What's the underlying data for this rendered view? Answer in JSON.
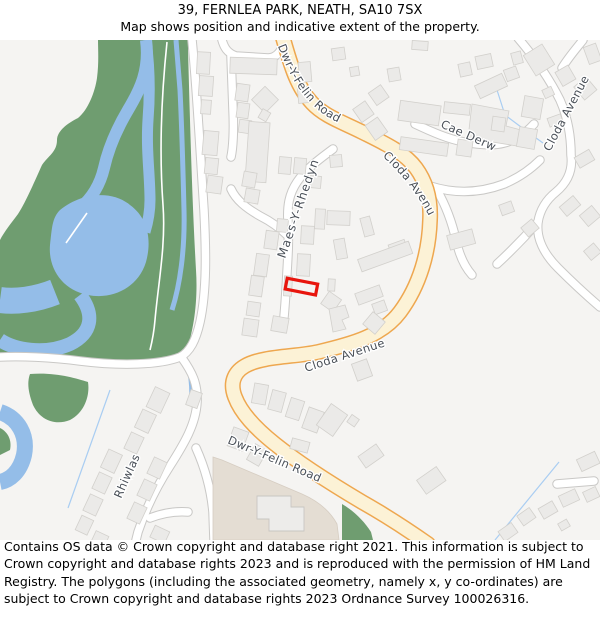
{
  "header": {
    "title": "39, FERNLEA PARK, NEATH, SA10 7SX",
    "subtitle": "Map shows position and indicative extent of the property."
  },
  "map": {
    "street_labels": {
      "dwr_y_felin_road_top": "Dwr-Y-Felin Road",
      "dwr_y_felin_road_bottom": "Dwr-Y-Felin Road",
      "cloda_avenue_main": "Cloda Avenue",
      "cloda_avenue_west": "Cloda Avenue",
      "cloda_avenue_east": "Cloda Avenue",
      "cae_derw": "Cae Derw",
      "maes_y_rhedyn": "Maes-Y-Rhedyn",
      "rhiwlas": "Rhiwlas"
    },
    "colors": {
      "map_background": "#f5f4f2",
      "woodland": "#6f9d70",
      "water": "#94bde8",
      "stream": "#a9cdf2",
      "road_primary": "#fcf2d6",
      "road_primary_casing": "#eea74f",
      "building": "#ebeae8",
      "school_grounds": "#e4ddd3",
      "property_outline": "#e8150d"
    }
  },
  "footer": {
    "copyright": "Contains OS data © Crown copyright and database right 2021. This information is subject to Crown copyright and database rights 2023 and is reproduced with the permission of HM Land Registry. The polygons (including the associated geometry, namely x, y co-ordinates) are subject to Crown copyright and database rights 2023 Ordnance Survey 100026316."
  }
}
